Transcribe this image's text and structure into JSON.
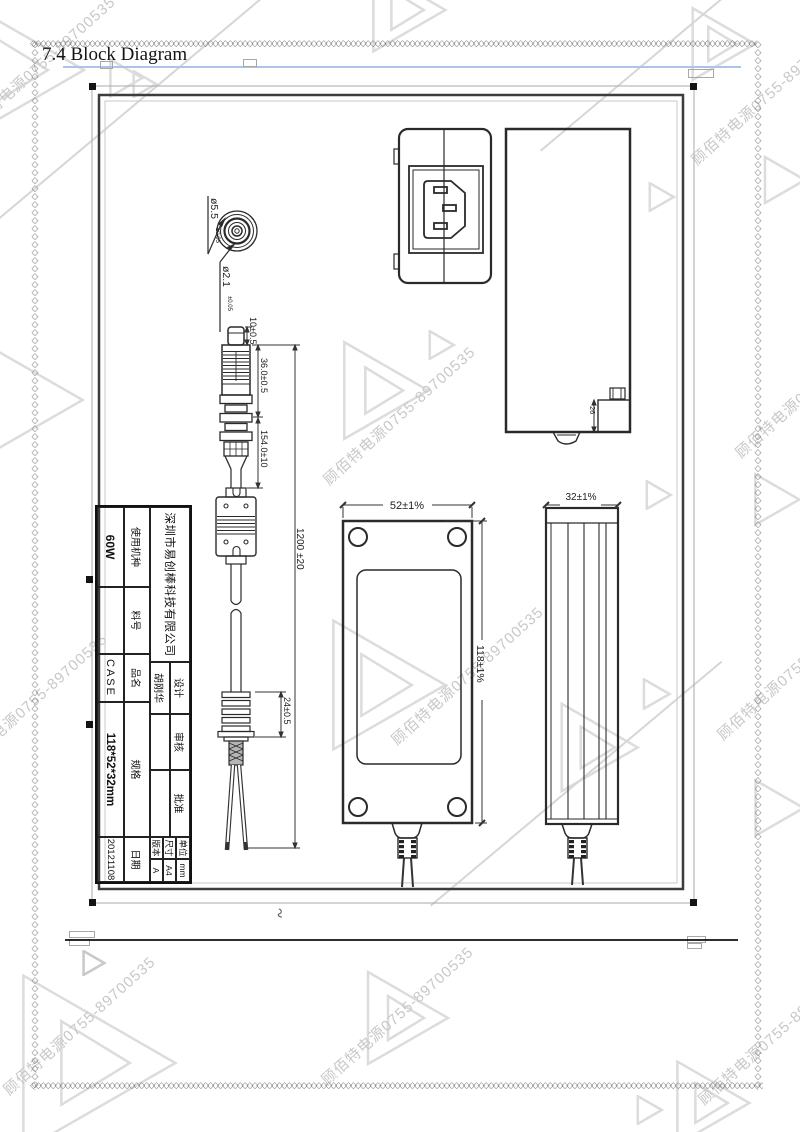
{
  "page": {
    "section_title": "7.4 Block Diagram",
    "watermark": {
      "text": "顾佰特电源0755-89700535",
      "color": "#c8c8c8"
    },
    "accent_line_color": "#a9c6e8"
  },
  "drawing": {
    "plug_section": {
      "outer_dia": "ø5.5",
      "outer_tol": "±0.05",
      "inner_dia": "ø2.1",
      "inner_tol": "±0.05"
    },
    "dims": {
      "tip": "10±0.5",
      "plug_body": "36.0±0.5",
      "plug_overall": "154.0±10",
      "cable": "1200 ±20",
      "strain_relief": "24±0.5",
      "case_width": "52±1%",
      "case_height": "118±1%",
      "case_depth": "32±1%",
      "jack_detail": "26"
    }
  },
  "title_block": {
    "company": "深圳市易创棒科技有限公司",
    "design_label": "设计",
    "design_value": "胡刚华",
    "review_label": "审核",
    "review_value": "",
    "approve_label": "批准",
    "approve_value": "",
    "unit_label": "单位",
    "unit_value": "mm",
    "size_label": "尺寸",
    "size_value": "A4",
    "version_label": "版本",
    "version_value": "A",
    "model_label": "使用机种",
    "model_value": "60W",
    "part_label": "料号",
    "part_value": "",
    "name_label": "品名",
    "name_value": "CASE",
    "spec_label": "规格",
    "spec_value": "118*52*32mm",
    "date_label": "日期",
    "date_value": "20121108"
  }
}
